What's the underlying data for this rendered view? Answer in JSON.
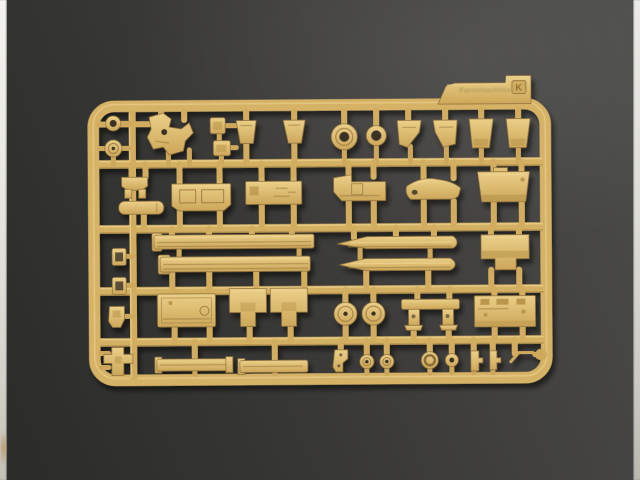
{
  "photo": {
    "subject": "Tan injection-molded plastic model kit sprue (parts tree) photographed on a dark gray textured background",
    "palette": {
      "plastic_tan": "#d7b468",
      "plastic_highlight": "#eed593",
      "plastic_shadow": "#8a6c38",
      "background_light": "#4c4c4a",
      "background_dark": "#2b2b29",
      "edge_strip": "#e7e6e0",
      "hole_dark": "#3a3328"
    },
    "edge_strips": {
      "left": true,
      "right": true,
      "left_smudge_color": "#ac843e"
    }
  },
  "sprue": {
    "tab": {
      "embossed_text": "Panzerhaubitze",
      "sprue_letter": "K"
    },
    "frame": {
      "shape": "rounded-rectangle",
      "runner_rows": 4,
      "part_rows": 5
    },
    "parts_count": 46,
    "part_names": [
      "small-ring",
      "wheel-hub",
      "cradle-bracket",
      "small-box-a",
      "small-box-b",
      "trapezoid-plate-a",
      "trapezoid-plate-b",
      "turret-ring-disc",
      "large-ring",
      "mudguard-left",
      "mudguard-right",
      "bucket-plate-left",
      "bucket-plate-right",
      "engine-mount",
      "exhaust-cylinder",
      "hull-floor-panel",
      "stowage-box-panel",
      "glacis-plate",
      "fender-section",
      "rear-plate",
      "side-rail-a",
      "side-rail-b",
      "cradle-half-left",
      "cradle-half-right",
      "notched-housing",
      "latch-box-a",
      "latch-box-b",
      "towing-shackle",
      "transmission-cover",
      "suspension-bracket-left",
      "suspension-bracket-right",
      "road-wheel-a",
      "road-wheel-b",
      "gun-mount-bench",
      "hatch-plate",
      "cross-fitting",
      "track-strip-a",
      "track-strip-b",
      "lifting-hook",
      "idler-wheel-a",
      "idler-wheel-b",
      "wheel-cap-ring",
      "washer-disc",
      "clamp-a",
      "clamp-b",
      "tow-cable-end"
    ]
  }
}
